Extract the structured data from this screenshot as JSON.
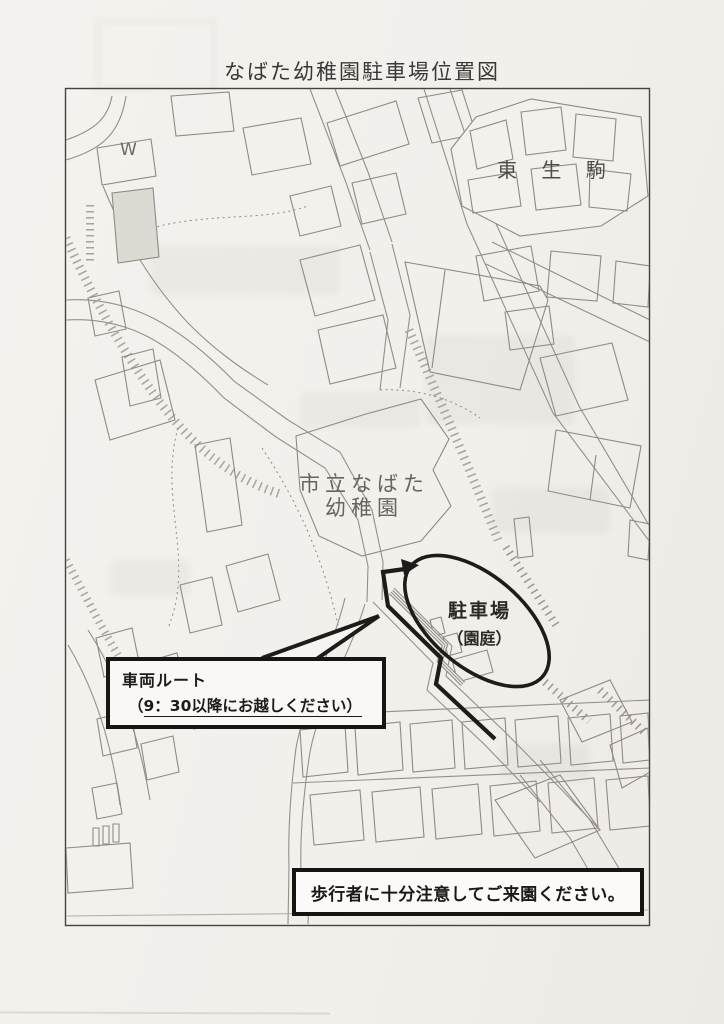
{
  "page": {
    "title": "なばた幼稚園駐車場位置図"
  },
  "map": {
    "labels": {
      "w_mark": "W",
      "district": "東 生 駒",
      "kindergarten_line1": "市立なばた",
      "kindergarten_line2": "幼稚園",
      "parking_line1": "駐車場",
      "parking_line2": "（園庭）"
    },
    "callout": {
      "line1": "車両ルート",
      "line2_prefix": "（",
      "line2_underlined": "9：30以降にお越しください）"
    },
    "notice": "歩行者に十分注意してご来園ください。"
  },
  "colors": {
    "paper": "#f3f1ec",
    "map_line_gray": "#8f8a84",
    "slope_hatch_gray": "#a8a39b",
    "label_gray": "#686460",
    "annotation_black": "#1d1c1b"
  }
}
